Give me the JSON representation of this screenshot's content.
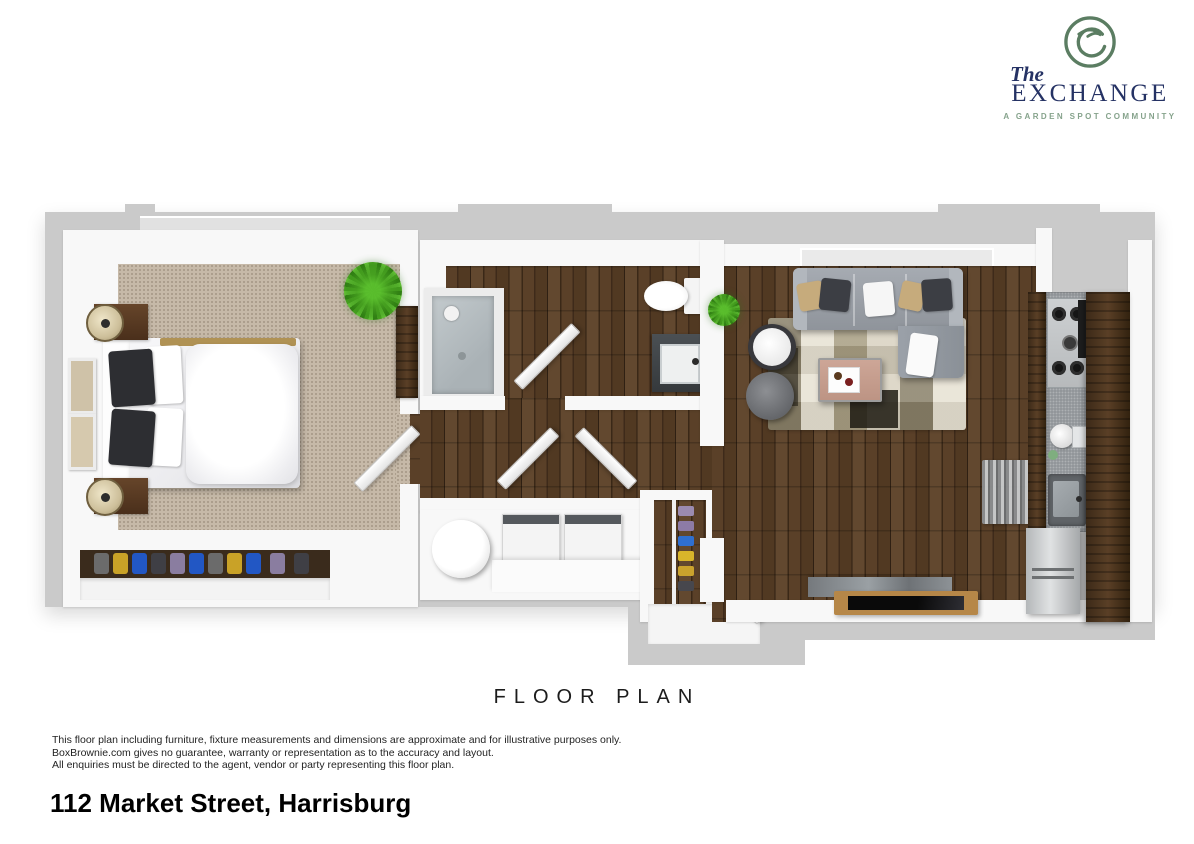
{
  "logo": {
    "the": "The",
    "name_caps": "EXCHANGE",
    "tagline": "A GARDEN SPOT COMMUNITY",
    "emblem_icon": "exchange-monogram-icon"
  },
  "title": {
    "text": "FLOOR PLAN"
  },
  "disclaimer": {
    "lines": [
      "This floor plan including furniture, fixture measurements and dimensions are approximate and for illustrative purposes only.",
      "BoxBrownie.com gives no guarantee, warranty or representation as to the accuracy and layout.",
      "All enquiries must be directed to the agent, vendor or party representing this floor plan."
    ]
  },
  "address": {
    "text": "112 Market Street, Harrisburg"
  },
  "floor_plan": {
    "style": "3d-top-down-render",
    "rooms": [
      {
        "name": "bedroom",
        "floor": "beige carpet",
        "furniture": [
          "double-bed",
          "nightstand-with-lamp",
          "nightstand-with-lamp",
          "wall-art-frame",
          "wall-art-frame",
          "closet-with-hanging-clothes",
          "dresser",
          "potted-plant",
          "door"
        ]
      },
      {
        "name": "bathroom",
        "floor": "dark wood",
        "furniture": [
          "walk-in-shower",
          "toilet",
          "vanity-sink",
          "door"
        ]
      },
      {
        "name": "hallway",
        "floor": "dark wood",
        "furniture": [
          "double-closet-doors"
        ]
      },
      {
        "name": "laundry-closet",
        "floor": "white",
        "furniture": [
          "washer",
          "dryer",
          "round-laundry-basket",
          "counter"
        ]
      },
      {
        "name": "entry",
        "floor": "dark wood",
        "furniture": [
          "double-entry-doors",
          "shoe-shelf"
        ]
      },
      {
        "name": "living-room",
        "floor": "dark wood",
        "furniture": [
          "sectional-sofa",
          "round-armchair",
          "ottoman-pouf",
          "coffee-table",
          "patchwork-area-rug",
          "tv-console",
          "tv",
          "potted-plant"
        ]
      },
      {
        "name": "kitchen",
        "floor": "dark wood",
        "furniture": [
          "gas-cooktop",
          "coffee-maker",
          "kitchen-sink",
          "pantry-cabinet",
          "refrigerator",
          "floor-mat"
        ]
      }
    ]
  },
  "theme": {
    "wall-gray": "#cacaca",
    "carpet": "#c6b9a8",
    "wood-dark": "#46301f",
    "logo-navy": "#253264",
    "logo-green": "#5b7d62",
    "logo-green-light": "#86a38c",
    "counter-gray": "#92969a"
  }
}
